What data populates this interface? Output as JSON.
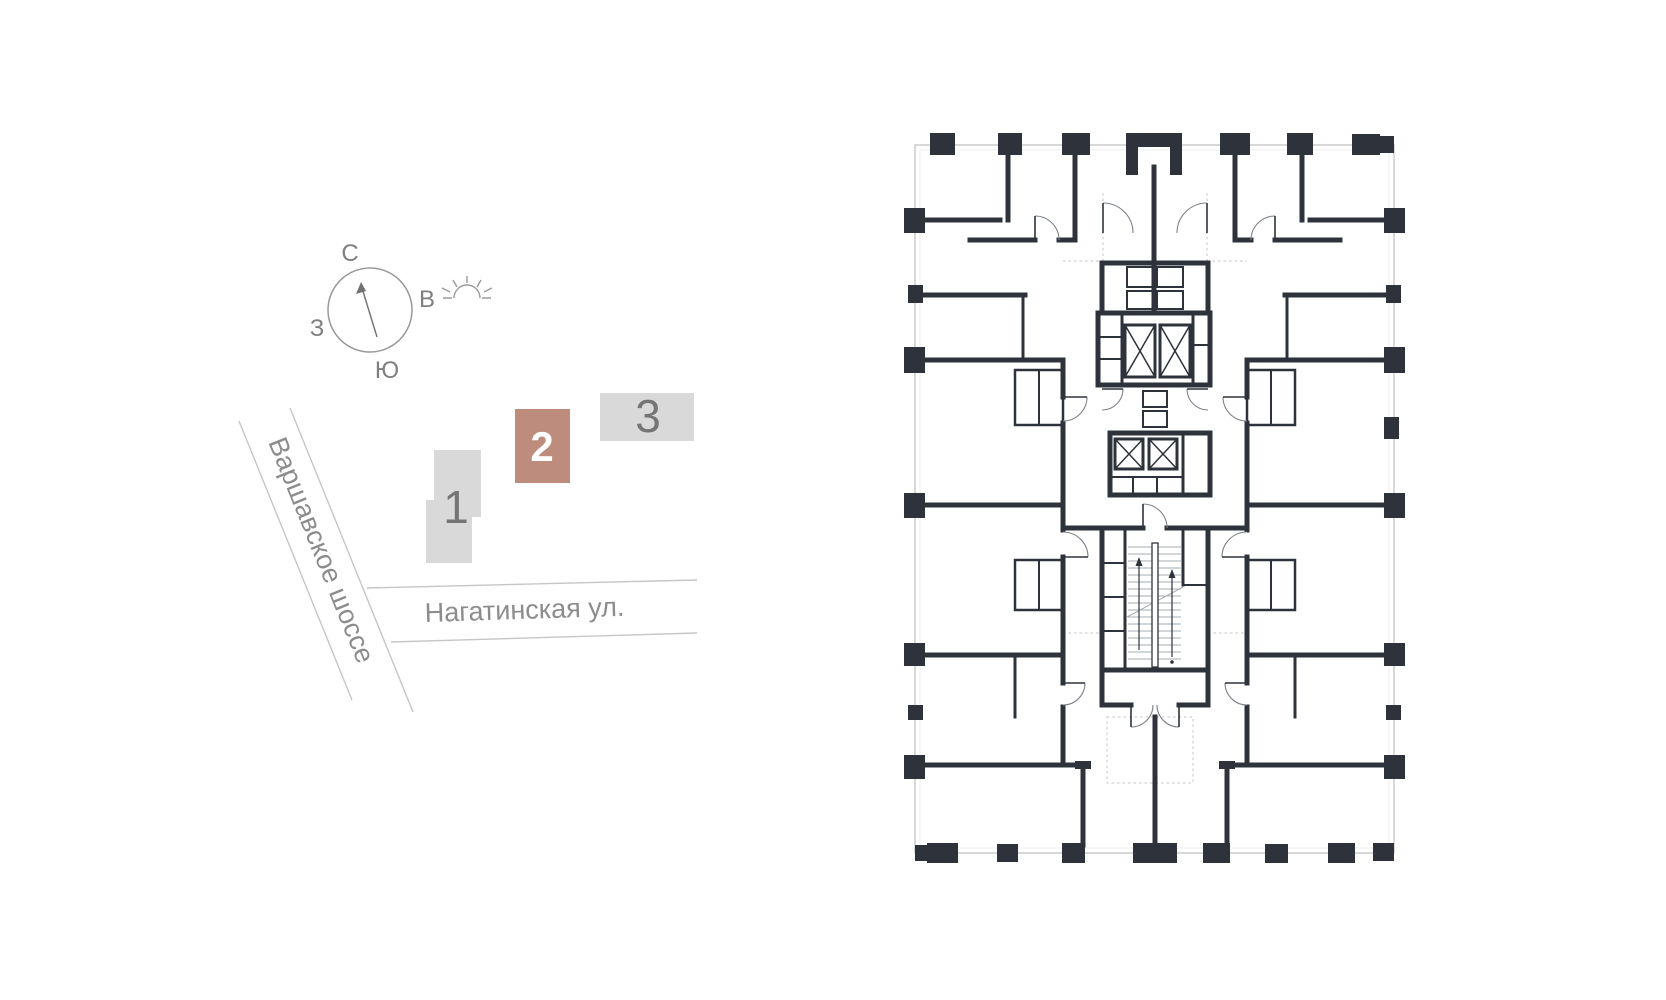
{
  "minimap": {
    "compass": {
      "north": "С",
      "east": "В",
      "south": "Ю",
      "west": "З"
    },
    "streets": [
      {
        "name": "Варшавское шоссе"
      },
      {
        "name": "Нагатинская ул."
      }
    ],
    "buildings": [
      {
        "label": "1",
        "highlighted": false,
        "color": "#d9d9d9"
      },
      {
        "label": "2",
        "highlighted": true,
        "color": "#bd8c7c"
      },
      {
        "label": "3",
        "highlighted": false,
        "color": "#d9d9d9"
      }
    ],
    "colors": {
      "accent": "#bd8c7c",
      "building_gray": "#d9d9d9",
      "street_line": "#c6c6c6",
      "text_gray": "#8c8c8c"
    }
  },
  "floorplan": {
    "colors": {
      "wall": "#2e333b",
      "boundary": "#c7c7c7",
      "door_arc": "#7d838a"
    }
  }
}
